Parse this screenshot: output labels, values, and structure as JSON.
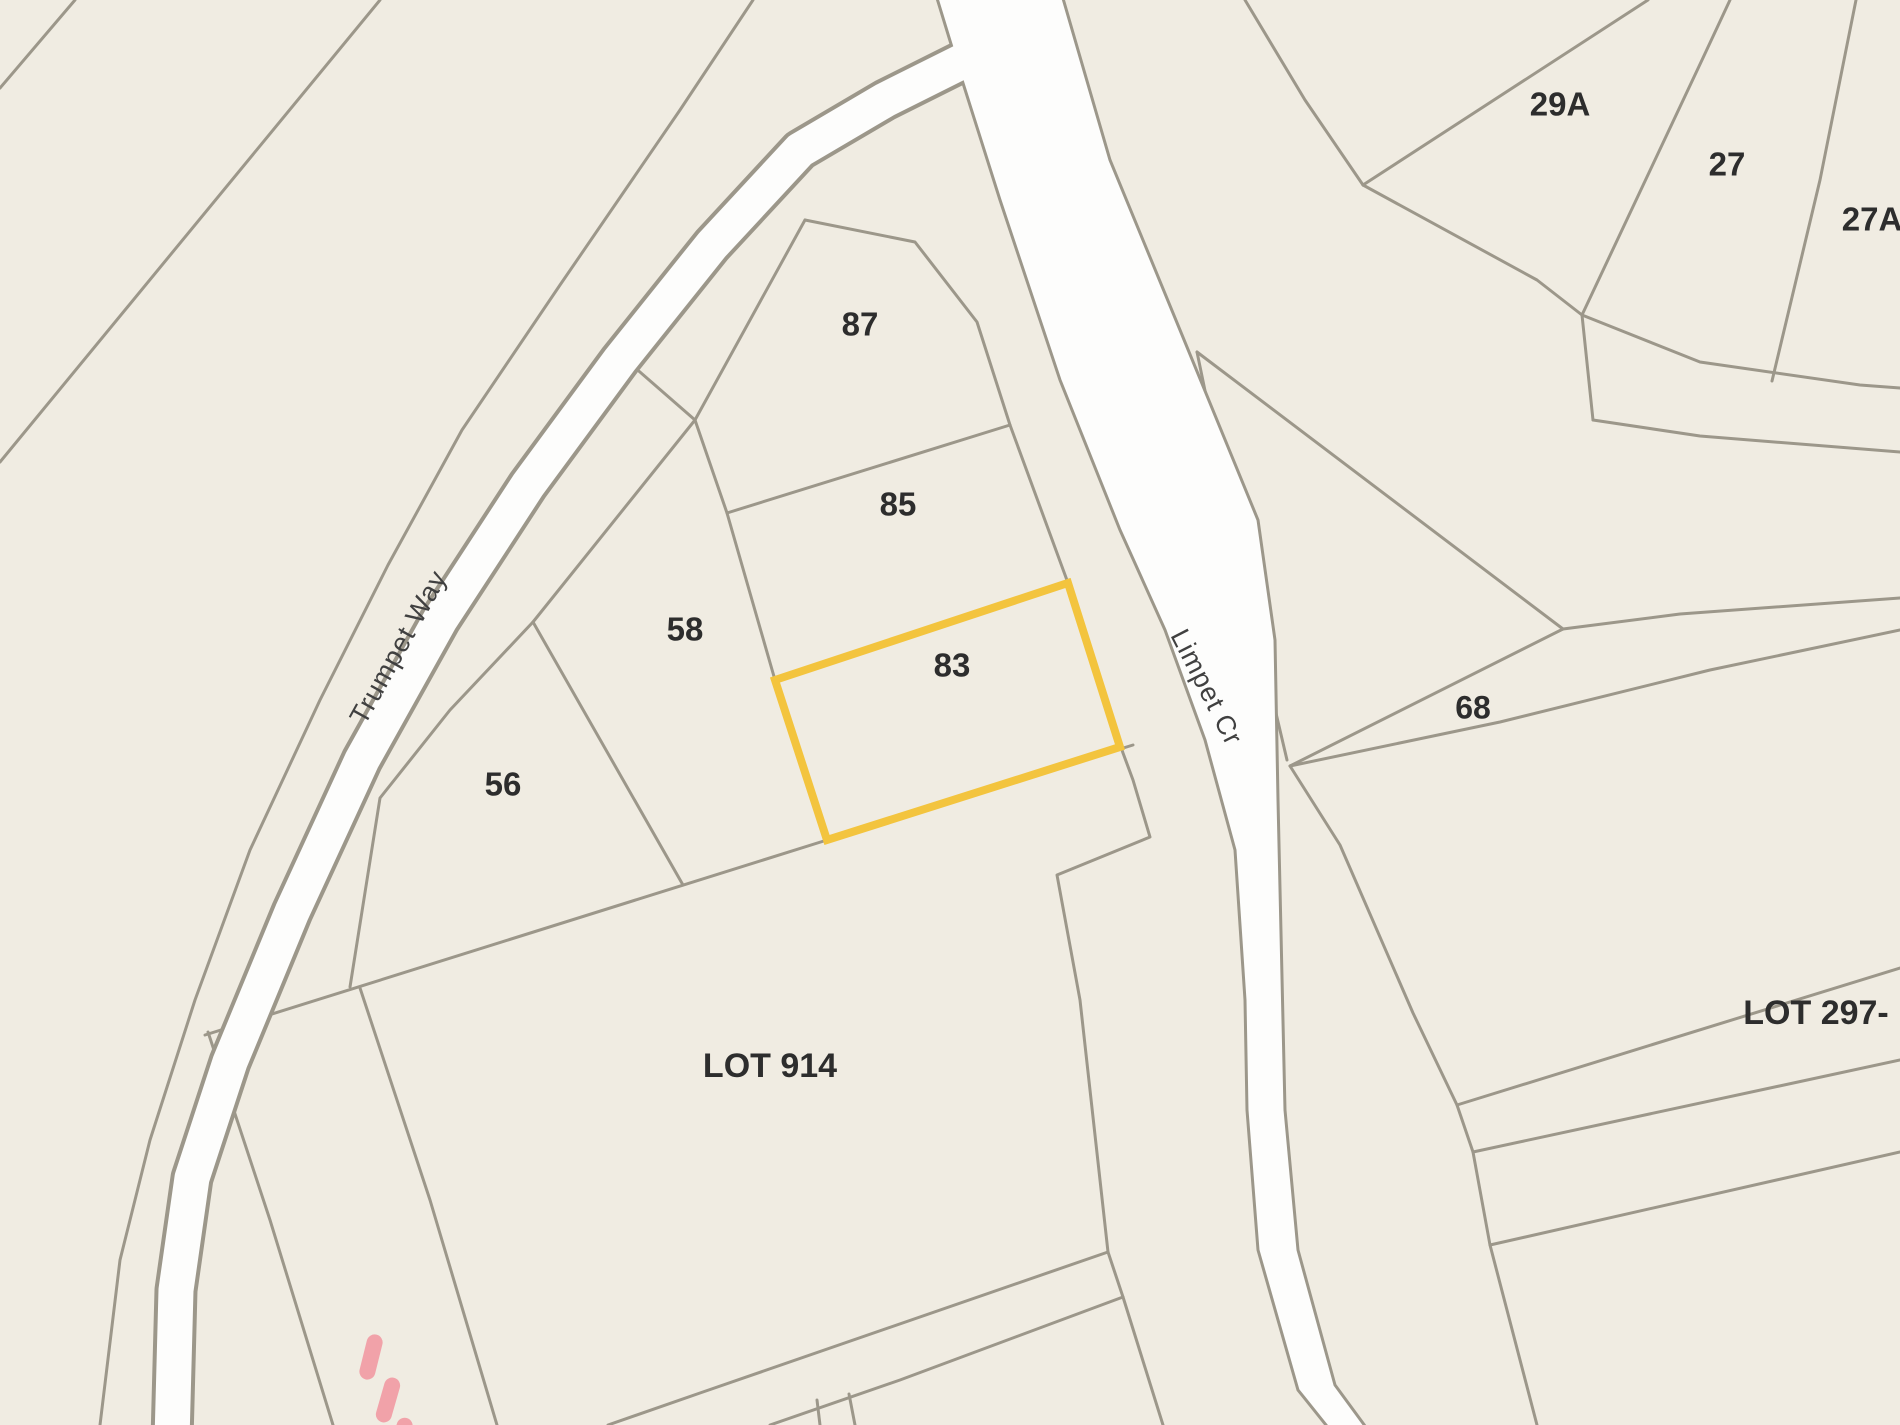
{
  "map": {
    "type": "cadastral-parcel-map",
    "background_color": "#f0ece2",
    "parcel_line_color": "#9c978a",
    "road_fill_color": "#fdfdfc",
    "highlight_color": "#f3c43e",
    "path_marking_color": "#f1a2a9",
    "label_color": "#2d2d2d",
    "street_label_color": "#404040",
    "highlighted_lot": "83",
    "streets": [
      {
        "name": "Trumpet Way",
        "x": 400,
        "y": 648,
        "rotation": -61,
        "size": 27
      },
      {
        "name": "Limpet Cr",
        "x": 1205,
        "y": 688,
        "rotation": 63,
        "size": 27
      }
    ],
    "lot_labels": [
      {
        "text": "87",
        "x": 860,
        "y": 327,
        "size": 33
      },
      {
        "text": "85",
        "x": 898,
        "y": 507,
        "size": 33
      },
      {
        "text": "83",
        "x": 952,
        "y": 668,
        "size": 33
      },
      {
        "text": "58",
        "x": 685,
        "y": 632,
        "size": 33
      },
      {
        "text": "56",
        "x": 503,
        "y": 787,
        "size": 33
      },
      {
        "text": "68",
        "x": 1473,
        "y": 710,
        "size": 32
      },
      {
        "text": "29A",
        "x": 1560,
        "y": 107,
        "size": 33
      },
      {
        "text": "27",
        "x": 1727,
        "y": 167,
        "size": 33
      },
      {
        "text": "27A",
        "x": 1872,
        "y": 222,
        "size": 33
      },
      {
        "text": "LOT 914",
        "x": 770,
        "y": 1068,
        "size": 34
      },
      {
        "text": "LOT 297-",
        "x": 1816,
        "y": 1015,
        "size": 34
      }
    ]
  }
}
